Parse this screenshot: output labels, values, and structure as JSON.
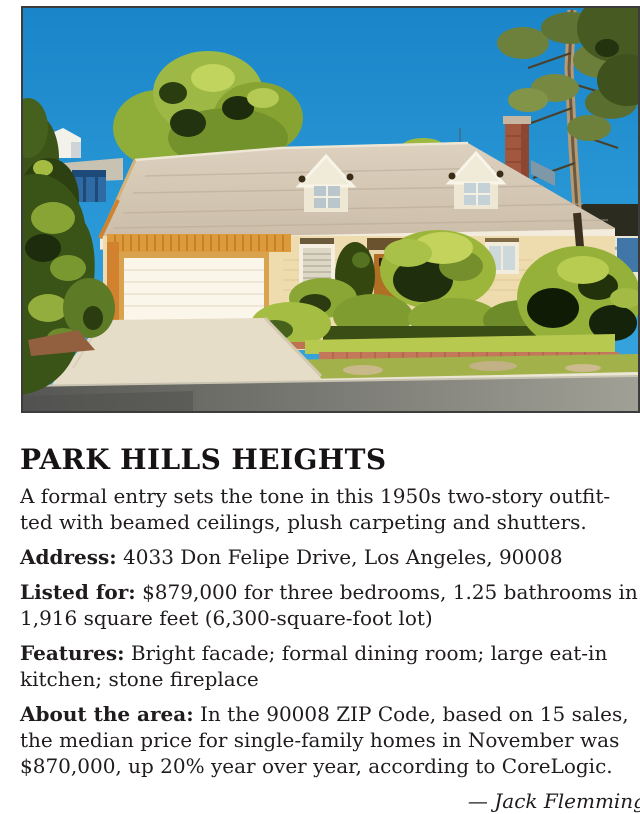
{
  "article": {
    "headline": "PARK HILLS HEIGHTS",
    "intro_lines": [
      "A formal entry sets the tone in this 1950s two-story outfit-",
      "ted with beamed ceilings, plush carpeting and shutters."
    ],
    "details": [
      {
        "label": "Address:",
        "lines": [
          "4033 Don Felipe Drive, Los Angeles, 90008"
        ]
      },
      {
        "label": "Listed for:",
        "lines": [
          "$879,000 for three bedrooms, 1.25 bathrooms in",
          "1,916 square feet (6,300-square-foot lot)"
        ]
      },
      {
        "label": "Features:",
        "lines": [
          "Bright facade; formal dining room; large eat-in",
          "kitchen; stone fireplace"
        ]
      },
      {
        "label": "About the area:",
        "lines": [
          "In the 90008 ZIP Code, based on 15 sales,",
          "the median price for single-family homes in November was",
          "$870,000, up 20% year over year, according to CoreLogic."
        ]
      }
    ],
    "byline": "— Jack Flemming"
  },
  "photo": {
    "type": "photograph",
    "subject": "Tan single-family house with gray gabled roof, two dormers, brick chimney, white double garage door, concrete driveway, trimmed hedges and tall trees under a clear blue sky",
    "border_color": "#3c3c3c",
    "palette": {
      "sky": "#2a98d6",
      "roof": "#d2c5b2",
      "wall": "#eedcae",
      "trim_orange": "#dd9a3b",
      "foliage": "#9cb63b",
      "street": "#7c7c78",
      "chimney_brick": "#a2573f"
    }
  }
}
